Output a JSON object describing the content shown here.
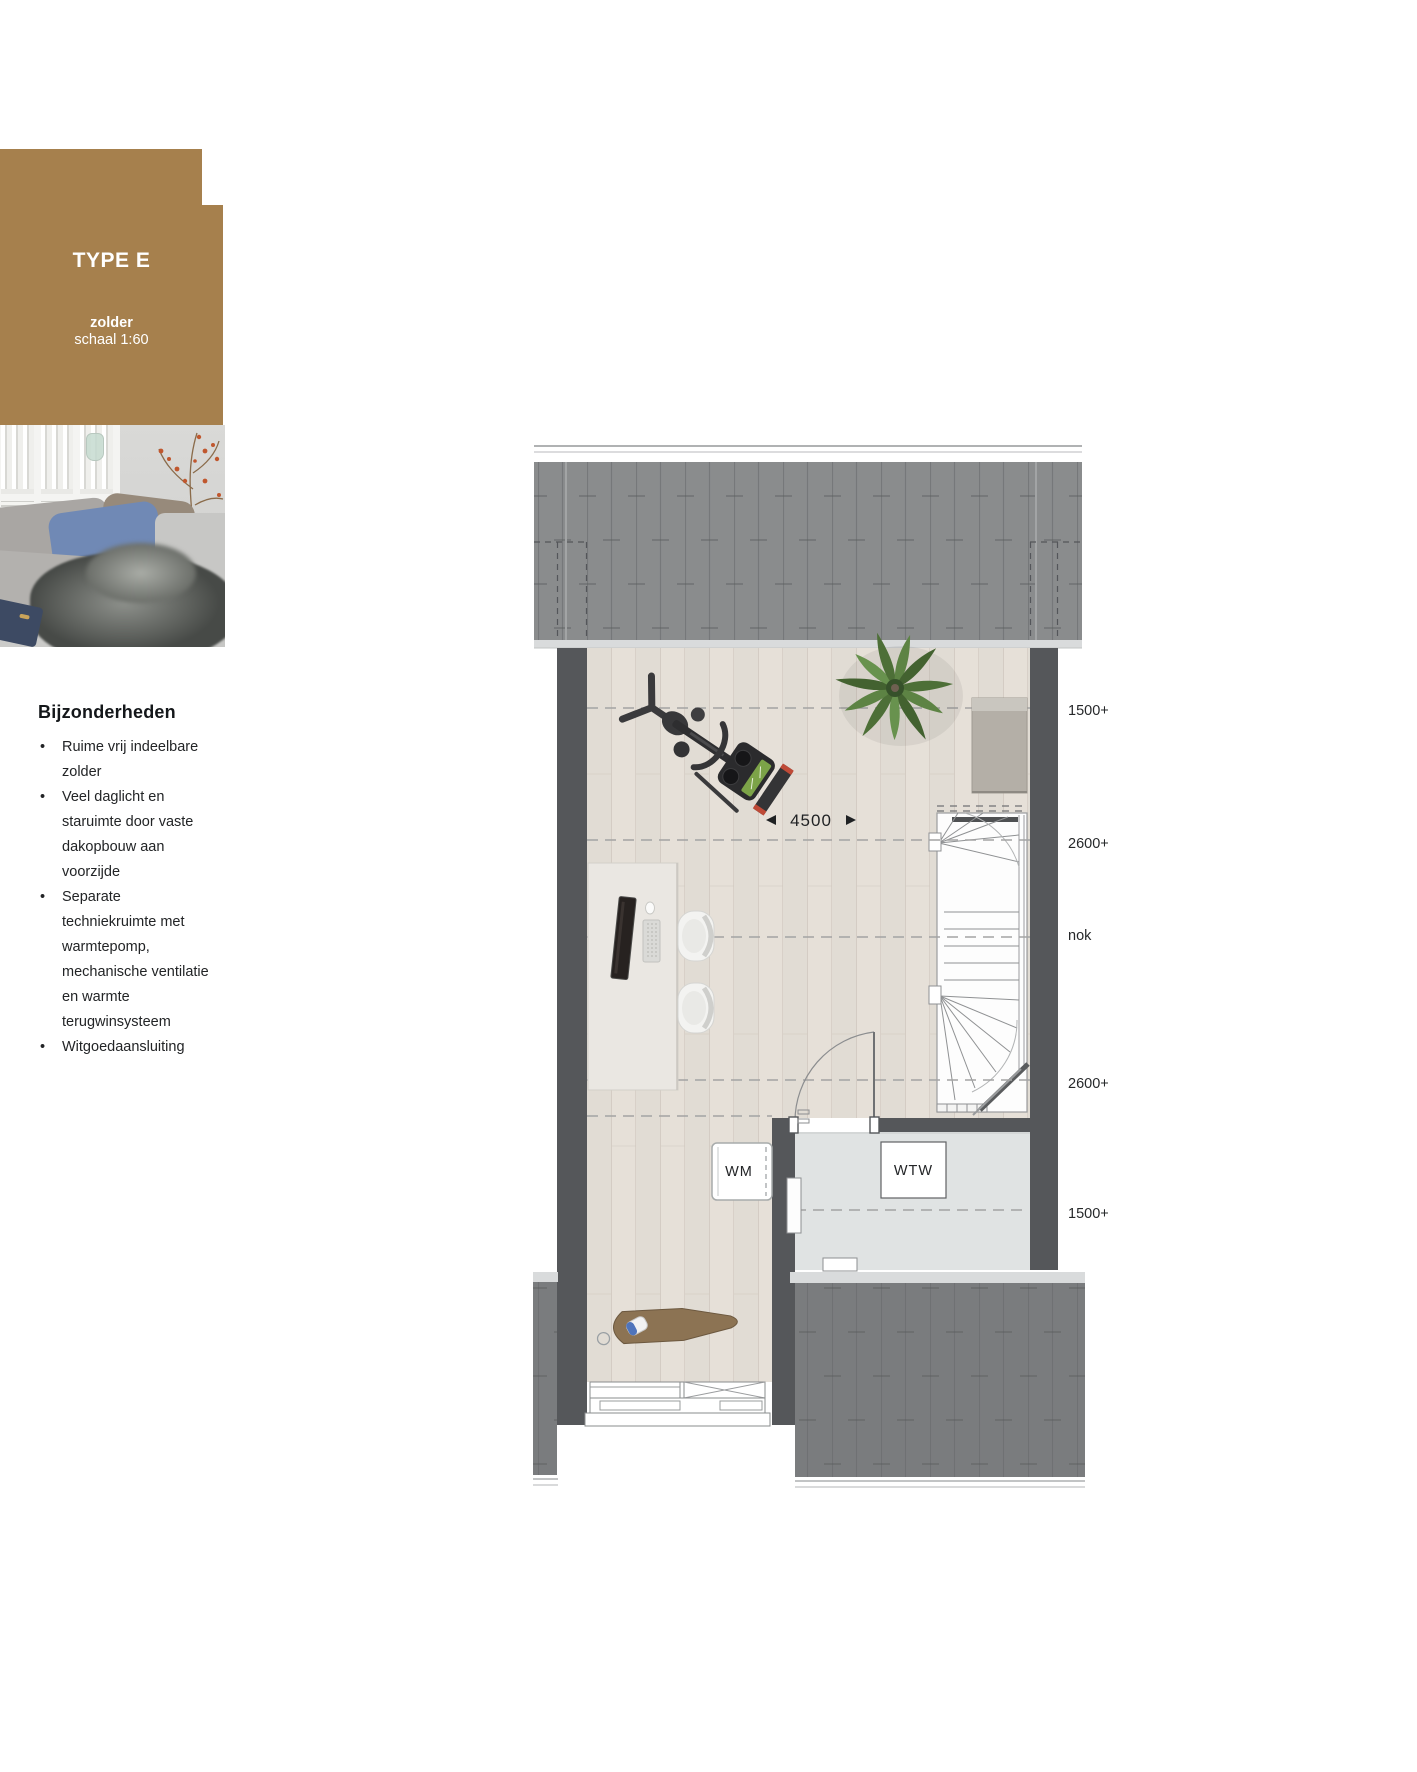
{
  "header": {
    "title": "TYPE E",
    "room": "zolder",
    "scale": "schaal 1:60",
    "bg_color": "#a6804d",
    "text_color": "#ffffff"
  },
  "features": {
    "heading": "Bijzonderheden",
    "items": [
      "Ruime vrij indeelbare zolder",
      "Veel daglicht en staruimte door vaste dakopbouw aan voorzijde",
      "Separate techniekruimte met warmtepomp, mechanische ventilatie en warmte terugwinsysteem",
      "Witgoedaansluiting"
    ]
  },
  "plan": {
    "dimension": "4500",
    "levels": [
      "1500+",
      "2600+",
      "nok",
      "2600+",
      "1500+"
    ],
    "rooms": {
      "wm": "WM",
      "wtw": "WTW"
    },
    "colors": {
      "roof": "#8a8c8d",
      "roof_dark": "#7a7c7e",
      "roof_seam": "#6f7173",
      "eave": "#d9dbdc",
      "wall": "#55575a",
      "wood_floor": "#e6e0d8",
      "tech_floor": "#e0e3e3",
      "label_text": "#26282a",
      "plant_green": "#5d8344"
    }
  }
}
